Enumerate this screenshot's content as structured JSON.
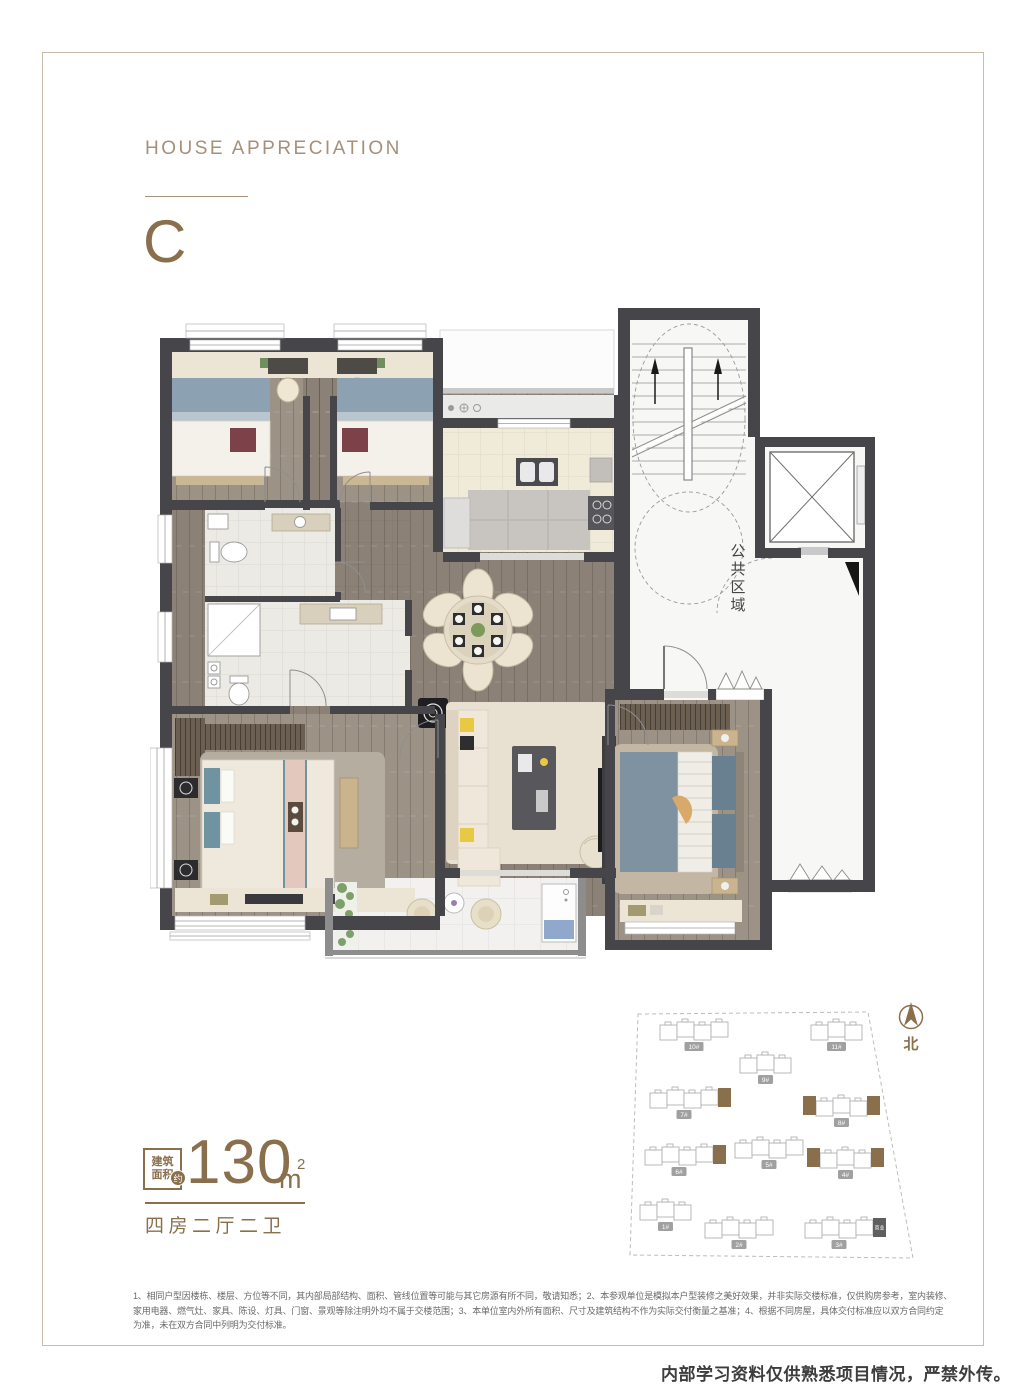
{
  "header": {
    "title": "HOUSE APPRECIATION",
    "unit_letter": "C"
  },
  "floorplan": {
    "public_area_label": "公共区域"
  },
  "area": {
    "box_line1": "建筑",
    "box_line2": "面积",
    "approx_badge": "约",
    "value": "130",
    "unit": "m",
    "sup": "2",
    "layout": "四房二厅二卫"
  },
  "siteplan": {
    "north_label": "北",
    "colors": {
      "highlight": "#8a6f4d",
      "badge": "#a0a0a0",
      "dark_unit": "#5f5f5f",
      "outline": "#a9a9a9"
    },
    "buildings": [
      {
        "label": "10#",
        "x": 40,
        "y": 22,
        "sections": 4,
        "highlight": "none"
      },
      {
        "label": "11#",
        "x": 191,
        "y": 22,
        "sections": 3,
        "highlight": "none"
      },
      {
        "label": "9#",
        "x": 120,
        "y": 55,
        "sections": 3,
        "highlight": "none"
      },
      {
        "label": "7#",
        "x": 30,
        "y": 90,
        "sections": 4,
        "highlight": "right"
      },
      {
        "label": "8#",
        "x": 196,
        "y": 98,
        "sections": 3,
        "highlight": "both"
      },
      {
        "label": "6#",
        "x": 25,
        "y": 147,
        "sections": 4,
        "highlight": "right"
      },
      {
        "label": "5#",
        "x": 115,
        "y": 140,
        "sections": 4,
        "highlight": "none"
      },
      {
        "label": "4#",
        "x": 200,
        "y": 150,
        "sections": 3,
        "highlight": "both"
      },
      {
        "label": "1#",
        "x": 20,
        "y": 202,
        "sections": 3,
        "highlight": "none"
      },
      {
        "label": "2#",
        "x": 85,
        "y": 220,
        "sections": 4,
        "highlight": "none"
      },
      {
        "label": "3#",
        "x": 185,
        "y": 220,
        "sections": 4,
        "highlight": "dark-right",
        "dark_label": "商业"
      }
    ]
  },
  "disclaimer": {
    "lines": [
      "1、相同户型因楼栋、楼层、方位等不同，其内部局部结构、面积、管线位置等可能与其它房源有所不同，敬请知悉；2、本参观单位是模拟本户型装修之美好效果，并非实际交楼标准，仅供购房参考，室内装修、",
      "家用电器、燃气灶、家具、陈设、灯具、门窗、景观等除注明外均不属于交楼范围；3、本单位室内外所有面积、尺寸及建筑结构不作为实际交付衡量之基准；4、根据不同房屋，具体交付标准应以双方合同约定",
      "为准，未在双方合同中列明为交付标准。"
    ]
  },
  "footer": {
    "notice": "内部学习资料仅供熟悉项目情况，严禁外传。"
  },
  "colors": {
    "brand": "#8a6f4d",
    "wall": "#46464a",
    "wood_hall": "#8b8177",
    "wood_room": "#9c9286",
    "cream": "#ece4d4"
  }
}
